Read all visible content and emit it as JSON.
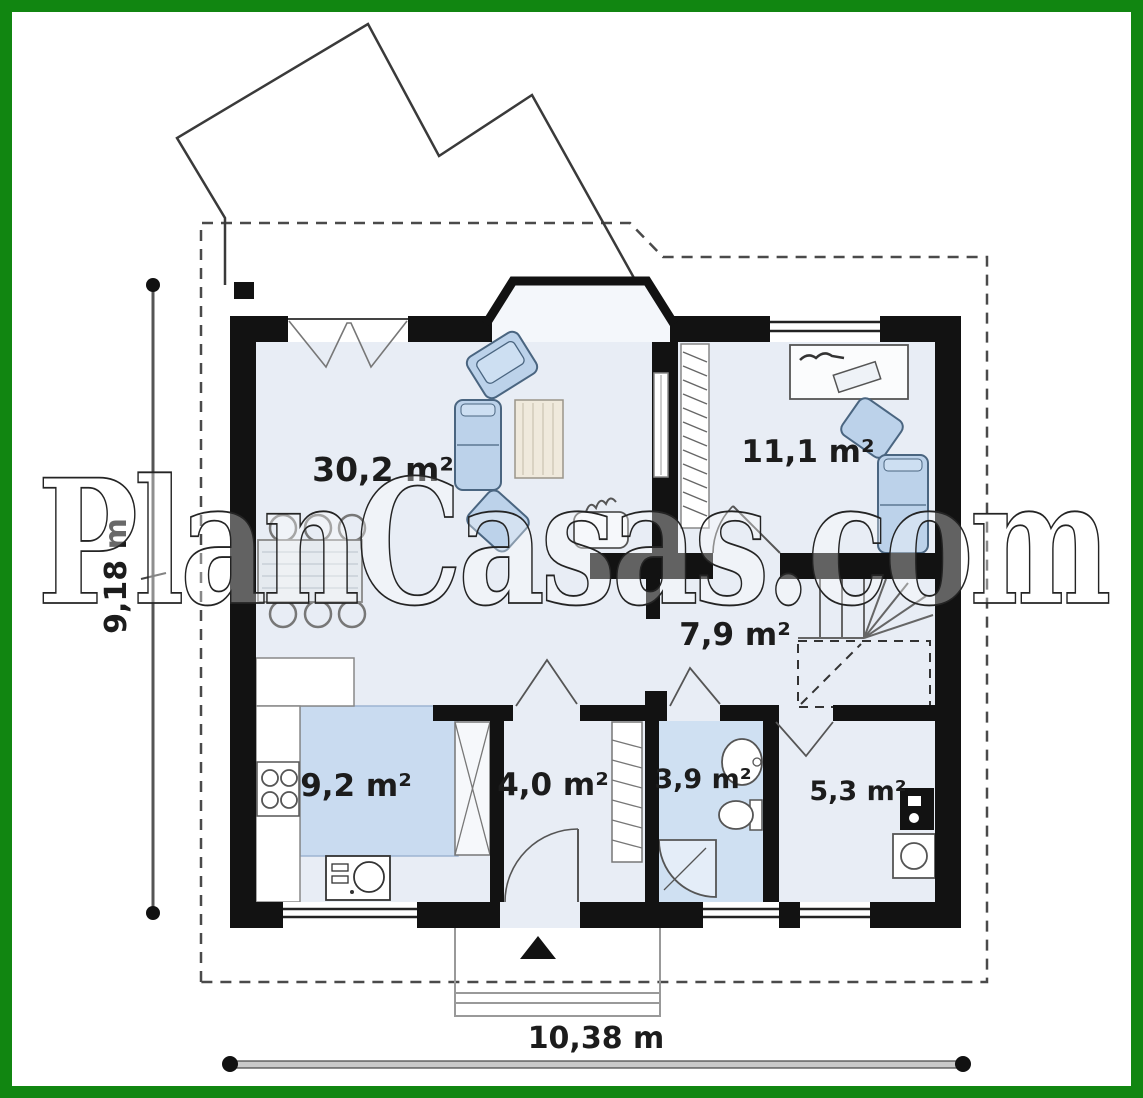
{
  "frame": {
    "border_color": "#118611",
    "background": "#ffffff"
  },
  "watermark": {
    "text": "PlanCasas.com"
  },
  "dimensions": {
    "width_label": "10,38 m",
    "height_label": "9,18 m"
  },
  "rooms": [
    {
      "id": "living-dining",
      "area_label": "30,2 m²"
    },
    {
      "id": "bedroom",
      "area_label": "11,1 m²"
    },
    {
      "id": "hall",
      "area_label": "7,9 m²"
    },
    {
      "id": "kitchen",
      "area_label": "9,2 m²"
    },
    {
      "id": "vestibule",
      "area_label": "4,0 m²"
    },
    {
      "id": "bathroom",
      "area_label": "3,9 m²"
    },
    {
      "id": "utility",
      "area_label": "5,3 m²"
    }
  ],
  "colors": {
    "wall": "#121212",
    "floor": "#e8edf5",
    "bay_floor": "#f4f7fb",
    "bathroom_floor": "#cfe0f2",
    "kitchen_cabinets": "#c9dbf0",
    "furniture_blue": "#bcd2ea"
  }
}
